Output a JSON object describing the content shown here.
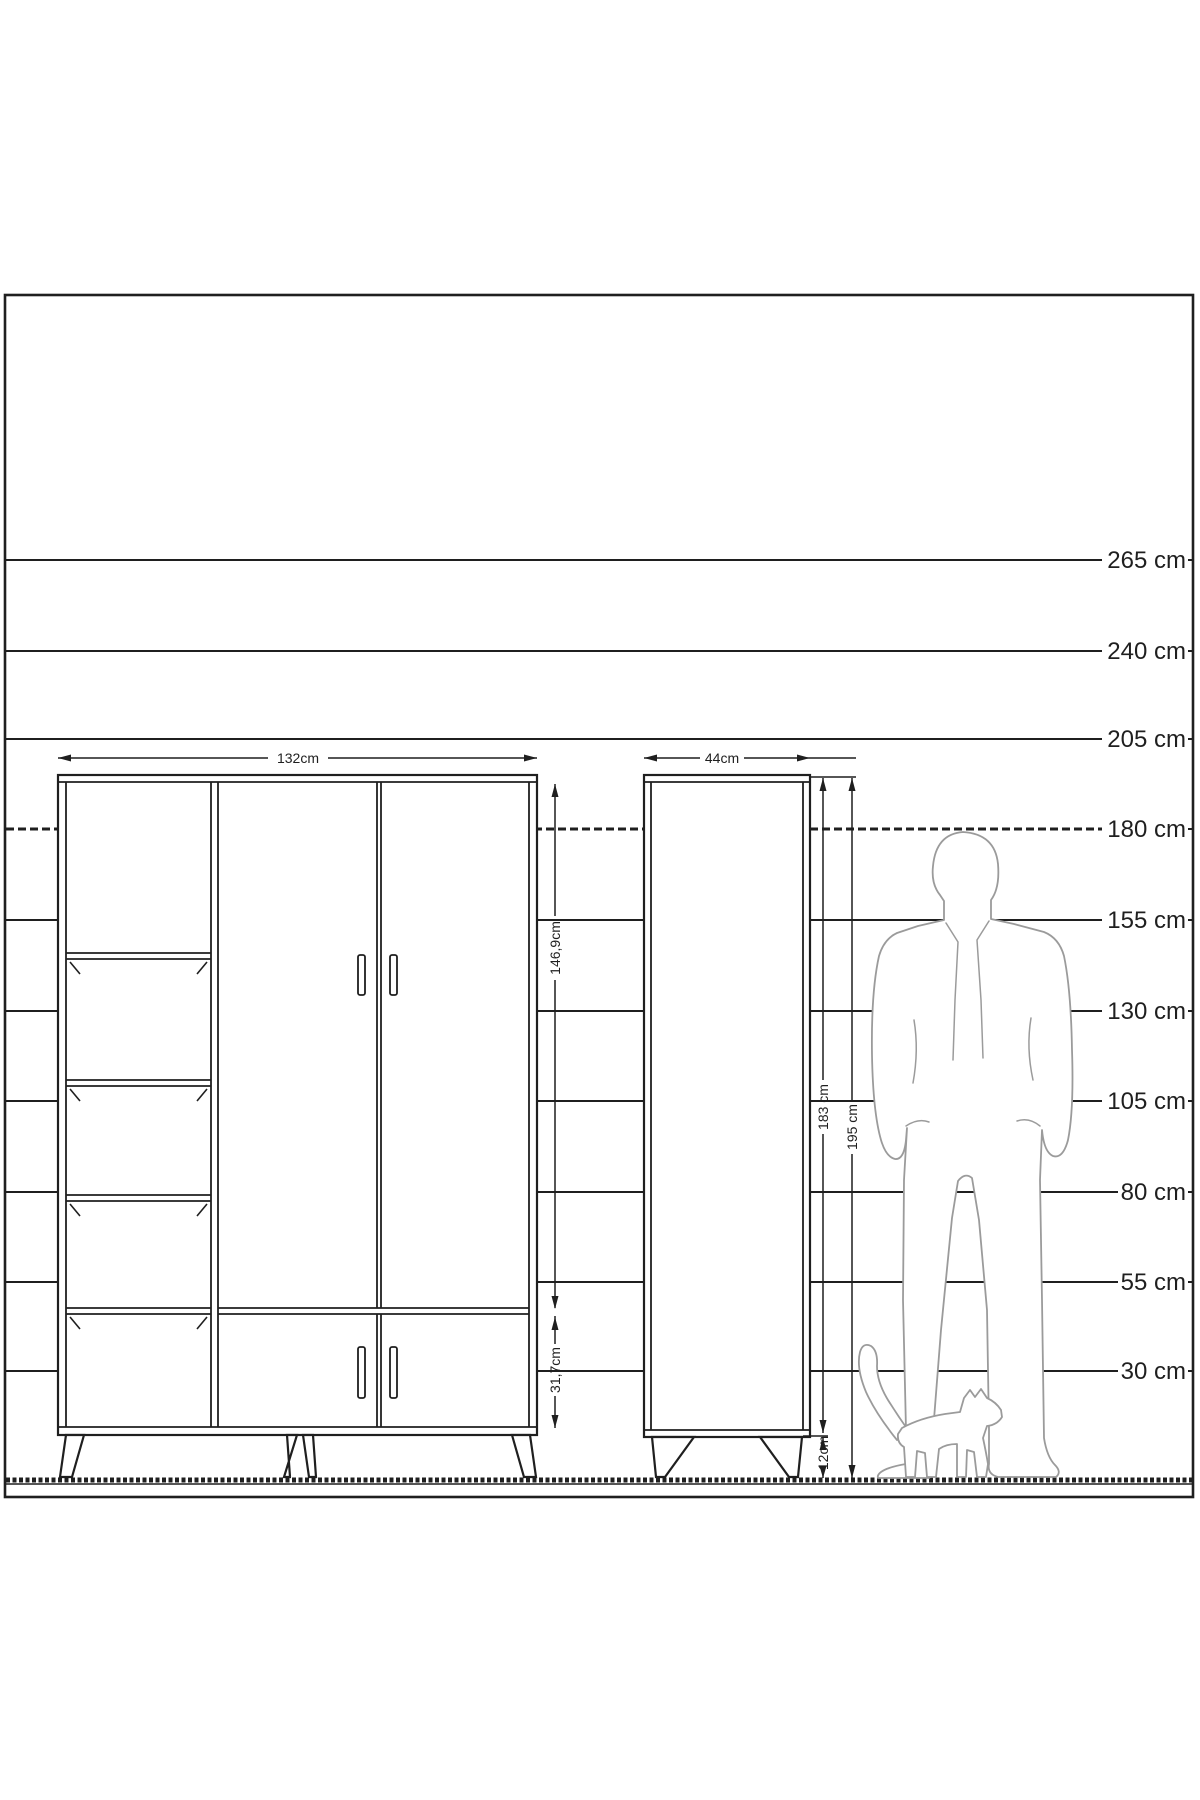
{
  "colors": {
    "line": "#1f1f1f",
    "silhouette": "#9b9b9b",
    "background": "#ffffff"
  },
  "height_ruler": {
    "unit": "cm",
    "labels": [
      {
        "label": "265 cm"
      },
      {
        "label": "240 cm"
      },
      {
        "label": "205 cm"
      },
      {
        "label": "180 cm"
      },
      {
        "label": "155 cm"
      },
      {
        "label": "130 cm"
      },
      {
        "label": "105 cm"
      },
      {
        "label": "80 cm"
      },
      {
        "label": "55 cm"
      },
      {
        "label": "30 cm"
      }
    ]
  },
  "front_wardrobe": {
    "width_label": "132cm",
    "door_height_label": "146,9cm",
    "drawer_height_label": "31,7cm"
  },
  "side_wardrobe": {
    "width_label": "44cm",
    "body_height_label": "183 cm",
    "total_height_label": "195 cm",
    "leg_height_label": "12cm"
  }
}
